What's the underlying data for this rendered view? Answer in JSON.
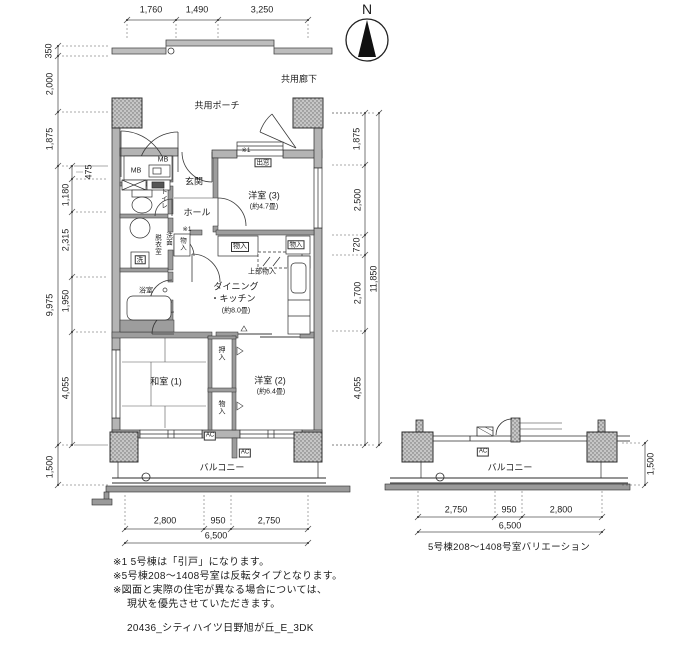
{
  "compass": {
    "north_label": "N"
  },
  "common": {
    "corridor": "共用廊下",
    "porch": "共用ポーチ"
  },
  "rooms": {
    "entrance": "玄関",
    "hall": "ホール",
    "western3": "洋室 (3)",
    "western3_area": "(約4.7畳)",
    "toilet": "トイレ",
    "washroom_col1": "洗面",
    "washroom_col2": "脱衣室",
    "washer": "洗",
    "bath": "浴室",
    "dk_line1": "ダイニング",
    "dk_line2": "・キッチン",
    "dk_area": "(約8.0畳)",
    "japanese1": "和室 (1)",
    "western2": "洋室 (2)",
    "western2_area": "(約6.4畳)",
    "balcony": "バルコニー"
  },
  "fixtures": {
    "mb1": "MB",
    "mb2": "MB",
    "bay_window": "出窓",
    "storage_hall": "物入",
    "storage_dk1": "物入",
    "storage_dk2": "物入",
    "upper_storage": "上部物入",
    "oshiire": "押入",
    "storage_bottom": "物入",
    "ac1": "AC",
    "ac2": "AC",
    "ref1": "※1",
    "ref2": "※1"
  },
  "dims": {
    "top": [
      "1,760",
      "1,490",
      "3,250"
    ],
    "left_outer": [
      "350",
      "2,000",
      "1,875",
      "9,975",
      "1,500"
    ],
    "left_inner": [
      "475",
      "1,180",
      "2,315",
      "1,950",
      "4,055"
    ],
    "right_inner": [
      "1,875",
      "2,500",
      "720",
      "2,700",
      "4,055"
    ],
    "right_total": "11,850",
    "bottom": [
      "2,800",
      "950",
      "2,750"
    ],
    "bottom_total": "6,500"
  },
  "variation": {
    "balcony": "バルコニー",
    "ac": "AC",
    "bottom": [
      "2,750",
      "950",
      "2,800"
    ],
    "bottom_total": "6,500",
    "side": "1,500",
    "caption": "5号棟208〜1408号室バリエーション"
  },
  "notes": {
    "line1": "※1 5号棟は「引戸」になります。",
    "line2": "※5号棟208〜1408号室は反転タイプとなります。",
    "line3": "※図面と実際の住宅が異なる場合については、",
    "line4": "現状を優先させていただきます。"
  },
  "footer": "20436_シティハイツ日野旭が丘_E_3DK"
}
